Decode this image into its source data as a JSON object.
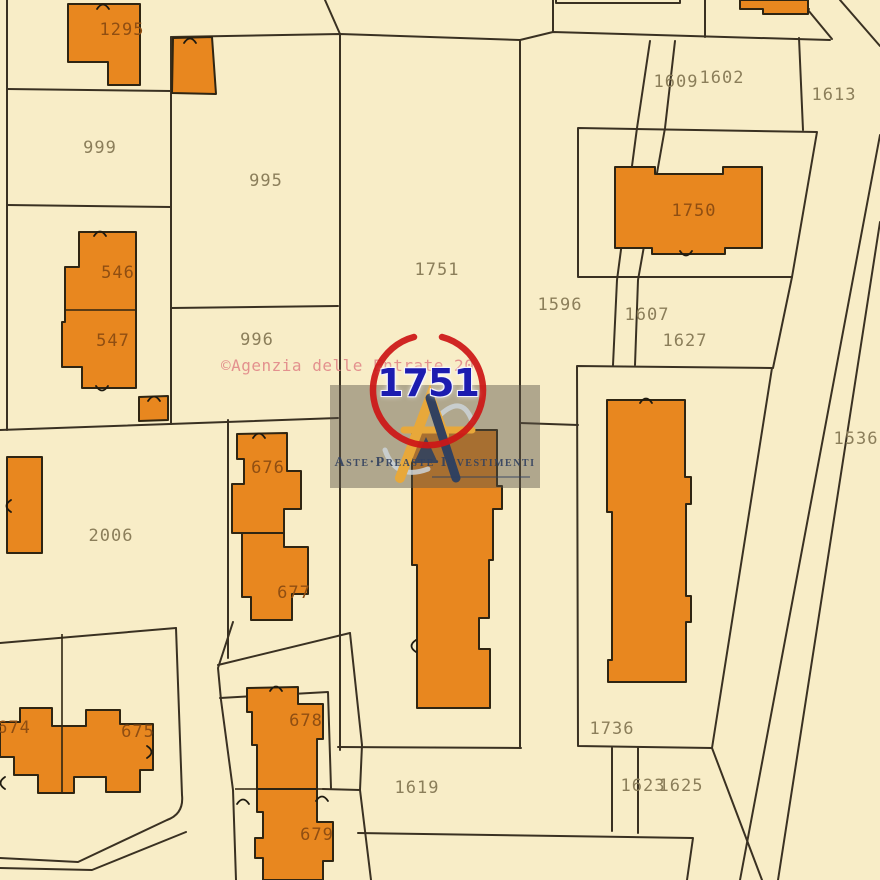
{
  "theme": {
    "background": "#f8edc7",
    "boundary": "#3a3122",
    "building_fill": "#e8871f",
    "building_stroke": "#2f2512",
    "parcel_label": "#8b7e5a",
    "building_label": "#8f4e12",
    "watermark_pink": "#e28a8a",
    "highlight_blue": "#1c1cb0",
    "highlight_red": "#cc1717",
    "overlay_gray": "rgba(88,83,70,0.45)",
    "brand_navy": "#31415f",
    "logo_amber": "#e8a83a",
    "logo_silver": "#ccd3d8"
  },
  "map": {
    "type": "cadastral-map",
    "parcel_labels": [
      {
        "text": "999",
        "x": 100,
        "y": 148
      },
      {
        "text": "995",
        "x": 266,
        "y": 181
      },
      {
        "text": "996",
        "x": 257,
        "y": 340
      },
      {
        "text": "2006",
        "x": 111,
        "y": 536
      },
      {
        "text": "1751",
        "x": 437,
        "y": 270
      },
      {
        "text": "1596",
        "x": 560,
        "y": 305
      },
      {
        "text": "1607",
        "x": 647,
        "y": 315
      },
      {
        "text": "1627",
        "x": 685,
        "y": 341
      },
      {
        "text": "1609",
        "x": 676,
        "y": 82
      },
      {
        "text": "1602",
        "x": 722,
        "y": 78
      },
      {
        "text": "1613",
        "x": 834,
        "y": 95
      },
      {
        "text": "1536",
        "x": 856,
        "y": 439
      },
      {
        "text": "1736",
        "x": 612,
        "y": 729
      },
      {
        "text": "1619",
        "x": 417,
        "y": 788
      },
      {
        "text": "1623",
        "x": 643,
        "y": 786
      },
      {
        "text": "1625",
        "x": 681,
        "y": 786
      }
    ],
    "building_labels": [
      {
        "text": "1295",
        "x": 122,
        "y": 30
      },
      {
        "text": "546",
        "x": 118,
        "y": 273
      },
      {
        "text": "547",
        "x": 113,
        "y": 341
      },
      {
        "text": "676",
        "x": 268,
        "y": 468
      },
      {
        "text": "677",
        "x": 294,
        "y": 593
      },
      {
        "text": "674",
        "x": 14,
        "y": 728
      },
      {
        "text": "675",
        "x": 138,
        "y": 732
      },
      {
        "text": "678",
        "x": 306,
        "y": 721
      },
      {
        "text": "679",
        "x": 317,
        "y": 835
      },
      {
        "text": "1750",
        "x": 694,
        "y": 211
      }
    ]
  },
  "highlight": {
    "text": "1751",
    "x": 428,
    "y": 383,
    "circle": {
      "cx": 428,
      "cy": 390,
      "r": 55
    }
  },
  "watermarks": {
    "agenzia": {
      "text": "©Agenzia delle Entrate 20",
      "x": 221,
      "y": 356
    },
    "agency_box": {
      "brand_text": "Aste·Preaste·Investimenti"
    }
  }
}
